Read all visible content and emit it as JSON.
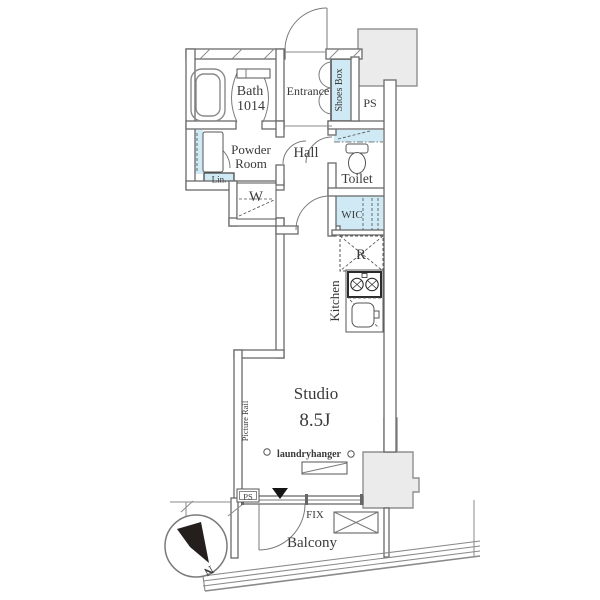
{
  "plan": {
    "rooms": {
      "bath": {
        "name": "Bath",
        "size": "1014"
      },
      "entrance": {
        "name": "Entrance"
      },
      "shoes_box": {
        "name": "Shoes Box"
      },
      "ps_top": {
        "name": "PS"
      },
      "powder_room": {
        "line1": "Powder",
        "line2": "Room"
      },
      "hall": {
        "name": "Hall"
      },
      "toilet": {
        "name": "Toilet"
      },
      "linen": {
        "name": "Lin."
      },
      "washer": {
        "name": "W"
      },
      "wic": {
        "name": "WIC"
      },
      "refrigerator": {
        "name": "R"
      },
      "kitchen": {
        "name": "Kitchen"
      },
      "studio": {
        "name": "Studio",
        "size": "8.5J"
      },
      "balcony": {
        "name": "Balcony"
      }
    },
    "annotations": {
      "picture_rail": "Picture Rail",
      "laundry_hanger": "laundryhanger",
      "ps_bottom": "PS",
      "fix_window": "FIX",
      "compass_north": "N"
    },
    "colors": {
      "fixture_blue": "#cfe9f5",
      "wall_gray": "#6a6a6a",
      "block_gray": "#ebebeb",
      "text": "#3a3a3a"
    }
  }
}
